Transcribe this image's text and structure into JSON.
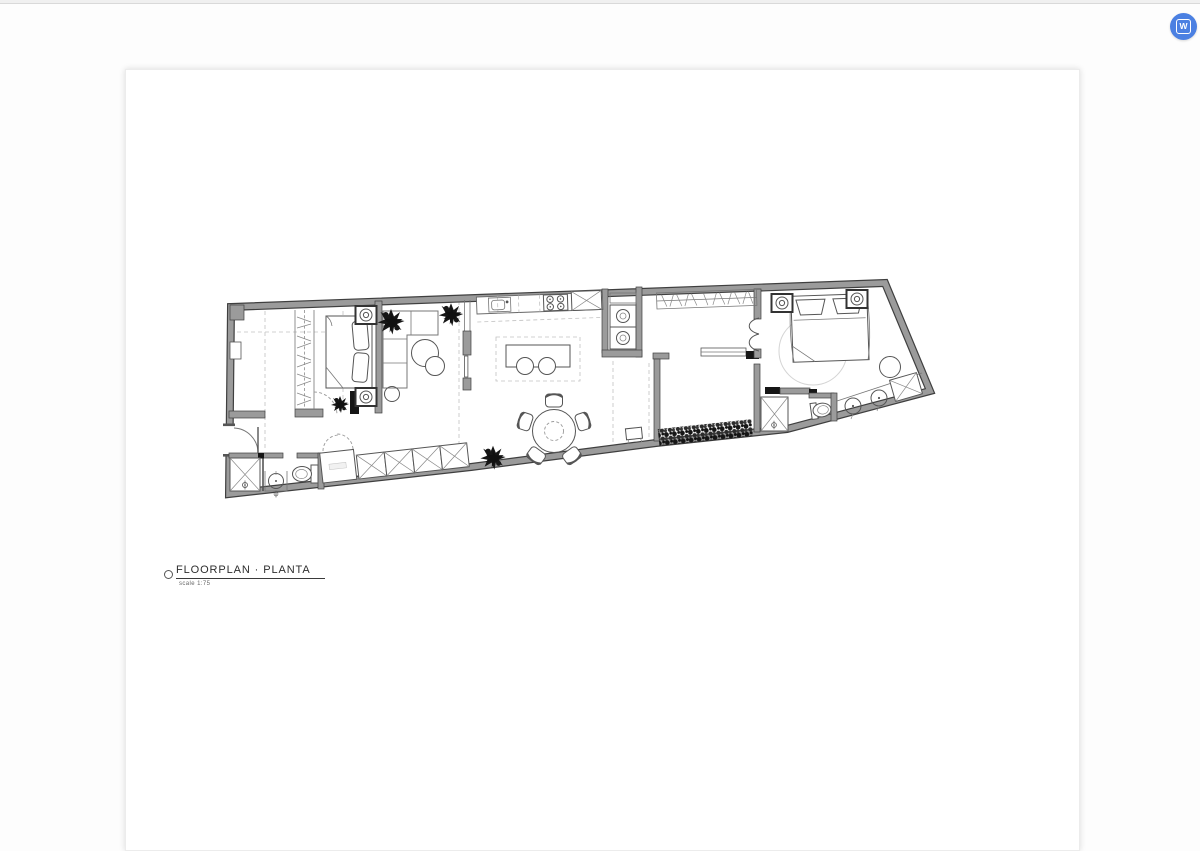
{
  "header": {
    "logo_letter": "W",
    "logo_color": "#4b80e2"
  },
  "canvas": {
    "title": "FLOORPLAN  · PLANTA",
    "scale_label": "scale 1:75"
  },
  "colors": {
    "wall_fill": "#9b9b9b",
    "wall_edge": "#3f3f3f",
    "line": "#555555",
    "dashed_guide": "#c2c2c2",
    "plant_black": "#161616",
    "page_background": "#ffffff",
    "topbar": "#f0f0f0"
  }
}
